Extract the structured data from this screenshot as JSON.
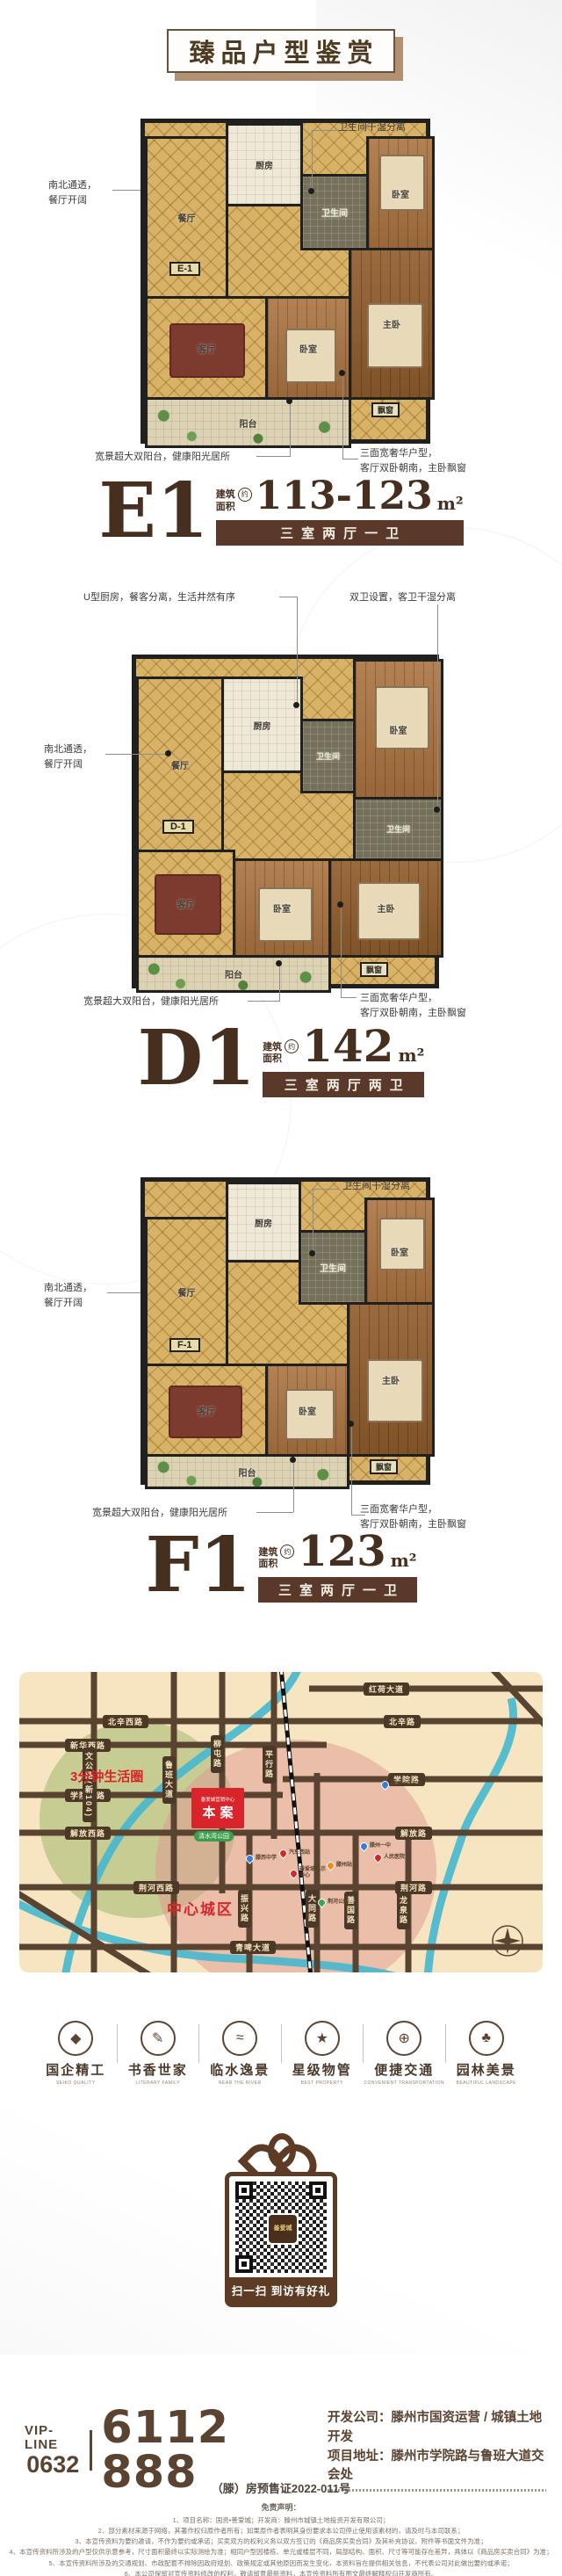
{
  "title": "臻品户型鉴赏",
  "plans": [
    {
      "code": "E1",
      "tag": "E-1",
      "area_cap1": "建筑",
      "area_cap2": "面积",
      "approx": "约",
      "area": "113-123",
      "unit": "m²",
      "type": "三室两厅一卫",
      "rooms": {
        "kitchen": "厨房",
        "dining": "餐厅",
        "bath": "卫生间",
        "bed1": "卧室",
        "bed2": "卧室",
        "master": "主卧",
        "living": "客厅",
        "balcony": "阳台",
        "bay": "飘窗"
      },
      "callouts": {
        "top": "卫生间干湿分离",
        "left": "南北通透，\n餐厅开阔",
        "bottom_left": "宽景超大双阳台，健康阳光居所",
        "bottom_right": "三面宽奢华户型，\n客厅双卧朝南，主卧飘窗"
      }
    },
    {
      "code": "D1",
      "tag": "D-1",
      "area_cap1": "建筑",
      "area_cap2": "面积",
      "approx": "约",
      "area": "142",
      "unit": "m²",
      "type": "三室两厅两卫",
      "rooms": {
        "kitchen": "厨房",
        "dining": "餐厅",
        "bath1": "卫生间",
        "bath2": "卫生间",
        "bed1": "卧室",
        "bed2": "卧室",
        "master": "主卧",
        "living": "客厅",
        "balcony": "阳台",
        "bay": "飘窗"
      },
      "callouts": {
        "top_left": "U型厨房，餐客分离，生活井然有序",
        "top_right": "双卫设置，客卫干湿分离",
        "left": "南北通透，\n餐厅开阔",
        "bottom_left": "宽景超大双阳台，健康阳光居所",
        "bottom_right": "三面宽奢华户型，\n客厅双卧朝南，主卧飘窗"
      }
    },
    {
      "code": "F1",
      "tag": "F-1",
      "area_cap1": "建筑",
      "area_cap2": "面积",
      "approx": "约",
      "area": "123",
      "unit": "m²",
      "type": "三室两厅一卫",
      "rooms": {
        "kitchen": "厨房",
        "dining": "餐厅",
        "bath": "卫生间",
        "bed1": "卧室",
        "bed2": "卧室",
        "master": "主卧",
        "living": "客厅",
        "balcony": "阳台",
        "bay": "飘窗"
      },
      "callouts": {
        "top": "卫生间干湿分离",
        "left": "南北通透，\n餐厅开阔",
        "bottom_left": "宽景超大双阳台，健康阳光居所",
        "bottom_right": "三面宽奢华户型，\n客厅双卧朝南，主卧飘窗"
      }
    }
  ],
  "map": {
    "life_circle": "3分钟生活圈",
    "center_zone": "中心城区",
    "site": {
      "header": "善爱城营销中心",
      "label": "本案"
    },
    "park": "清水湾公园",
    "roads": {
      "honghe": "红荷大道",
      "beixinxi": "北辛西路",
      "beixin": "北辛路",
      "xinhuaxi": "新华西路",
      "xueyuanxi": "学院西路",
      "xueyuan": "学院路",
      "jiefangxi": "解放西路",
      "jiefang": "解放路",
      "jinghexi": "荆河西路",
      "jinghe": "荆河路",
      "qingpi": "青啤大道",
      "wengong": "文公路(新104)",
      "luban": "鲁班大道",
      "liutun": "柳屯路",
      "pingxing": "平行路",
      "zhenxing": "振兴路",
      "datong": "大同路",
      "shanguo": "善国路",
      "longquan": "龙泉路"
    },
    "pois": [
      {
        "label": "滕州一中东校",
        "color": "#3b7bd4"
      },
      {
        "label": "滕西中学",
        "color": "#3b7bd4"
      },
      {
        "label": "汽车西站",
        "color": "#d9242b"
      },
      {
        "label": "善爱城展示中心",
        "color": "#d9242b"
      },
      {
        "label": "滕州站",
        "color": "#f08c1e"
      },
      {
        "label": "滕州一中",
        "color": "#3b7bd4"
      },
      {
        "label": "人民医院",
        "color": "#d9242b"
      },
      {
        "label": "荆河公园",
        "color": "#3aa757"
      }
    ]
  },
  "features": [
    {
      "label": "国企精工",
      "en": "SEIKO QUALITY",
      "icon": "gem-icon",
      "glyph": "◆"
    },
    {
      "label": "书香世家",
      "en": "LITERARY FAMILY",
      "icon": "pen-icon",
      "glyph": "✎"
    },
    {
      "label": "临水逸景",
      "en": "NEAR THE RIVER",
      "icon": "water-icon",
      "glyph": "≈"
    },
    {
      "label": "星级物管",
      "en": "BEST PROPERTY",
      "icon": "star-icon",
      "glyph": "★"
    },
    {
      "label": "便捷交通",
      "en": "CONVENIENT TRANSPORTATION",
      "icon": "wheel-icon",
      "glyph": "⊕"
    },
    {
      "label": "园林美景",
      "en": "BEAUTIFUL LANDSCAPE",
      "icon": "tree-icon",
      "glyph": "♣"
    }
  ],
  "qr": {
    "caption": "扫一扫 到访有好礼",
    "logo_text": "善爱城"
  },
  "contact": {
    "vip_label": "VIP-LINE",
    "area_code": "0632",
    "phone": "6112 888",
    "developer": "开发公司：滕州市国资运营 / 城镇土地开发",
    "address": "项目地址：滕州市学院路与鲁班大道交会处"
  },
  "legal": {
    "presale": "（滕）房预售证2022-011号",
    "disclaimer_title": "免责声明：",
    "items": [
      "1、项目名称：国资•善爱城；开发商：滕州市城镇土地投资开发有限公司；",
      "2、部分素材来源于网络，其著作权归原作者所有；如果原作者表明其身份要求本公司停止使用该素材的，请及时与本司联系；",
      "3、本宣传资料为要约邀请，不作为要约或承诺；买卖双方的权利义务以双方签订的《商品房买卖合同》及其补充协议、附件等书面文件为准；",
      "4、本宣传资料所涉及的户型仅供示意参考，尺寸面积最终以实际测绘为准；相同户型因楼栋、单元或楼层不同，局部结构、面积、尺寸等可能存在差异，具体以《商品房买卖合同》为准；",
      "5、本宣传资料所涉及的交通规划、市政配套不排除因政府规划、政策规定或其他原因而发生变化，本资料旨在提供相关信息，不代表公司对此做出要约或承诺；",
      "6、本公司保留对宣传资料修改的权利，敬请留意最新资料，本宣传资料所有图文最终解释权归开发商所有。"
    ]
  }
}
